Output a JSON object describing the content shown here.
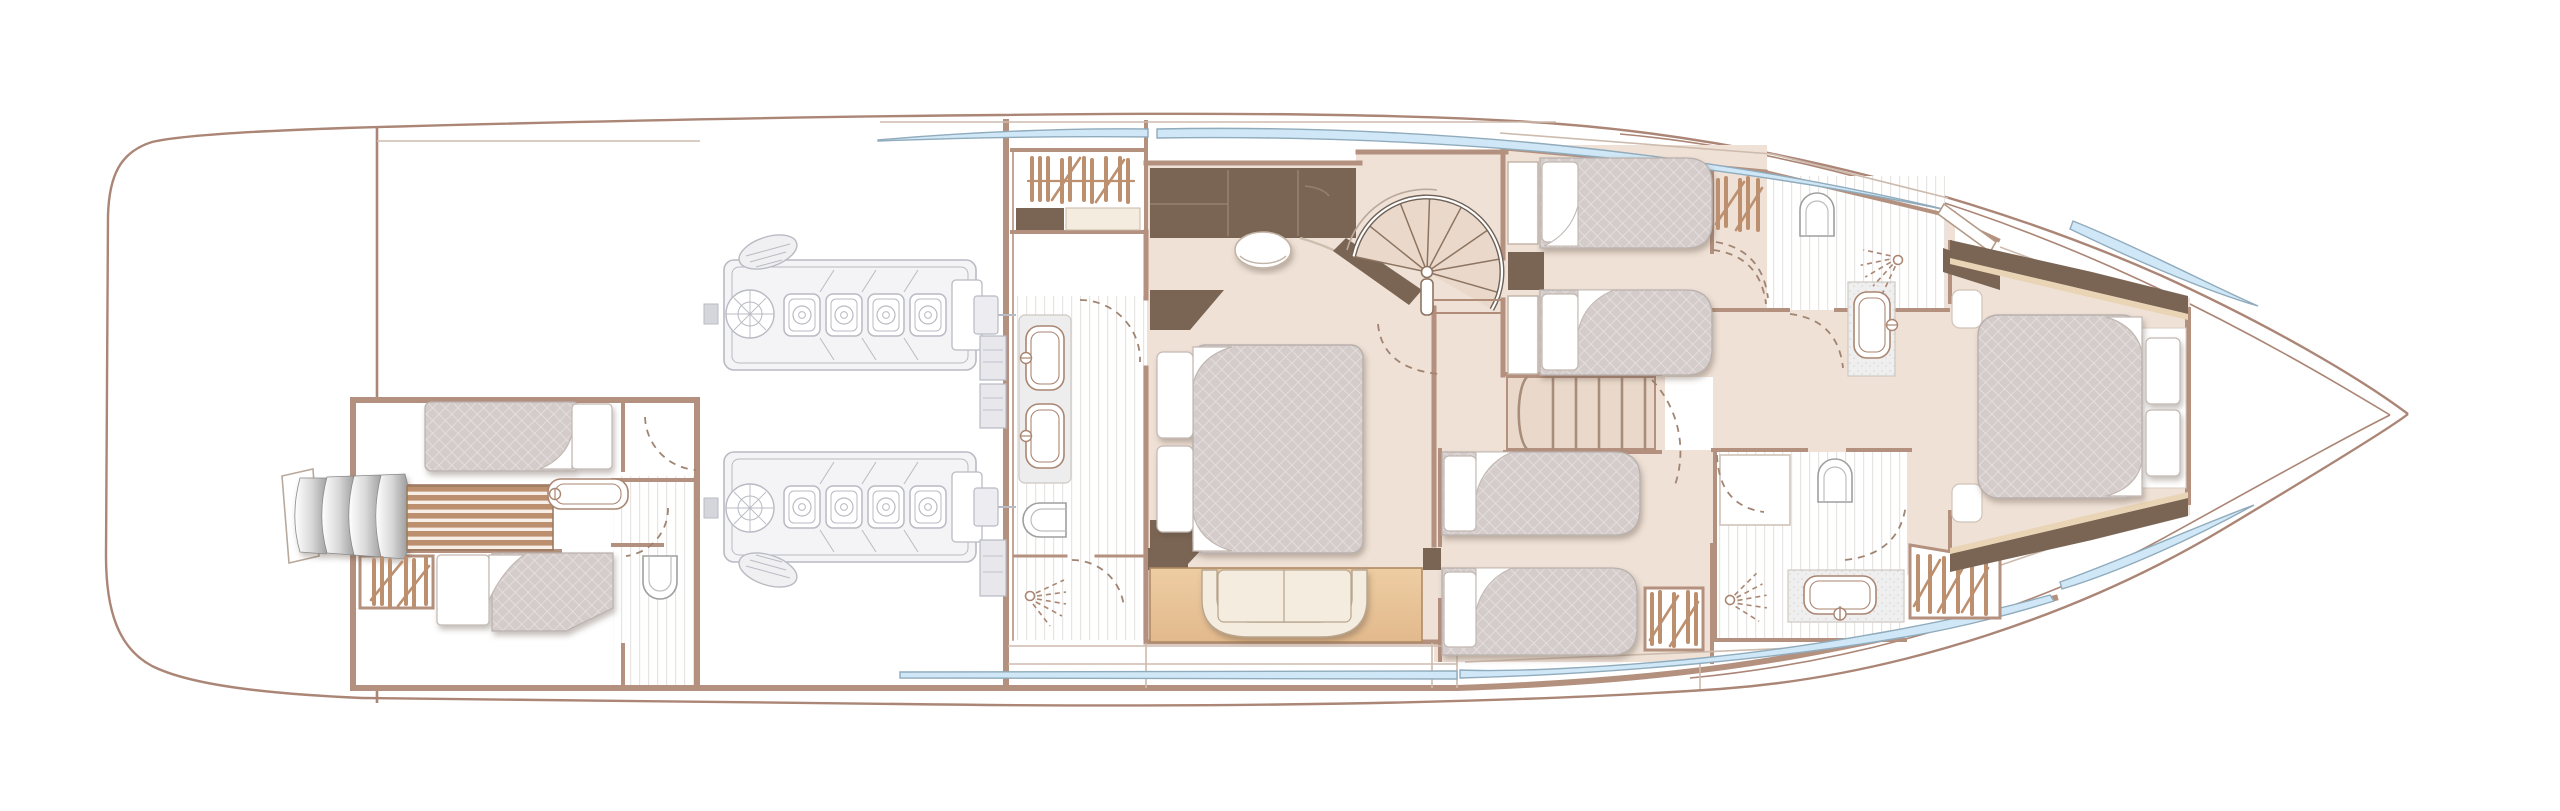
{
  "meta": {
    "title": "Yacht lower deck floor plan (no text labels in drawing)",
    "orientation": "bow-right",
    "canvas": {
      "width": 2560,
      "height": 811
    },
    "background": "#ffffff"
  },
  "palette": {
    "wall": "#b4907e",
    "hull": "#ab8575",
    "deck_line": "#cdbbae",
    "floor": "#efe1d6",
    "floor_warm": "#ead9cb",
    "fabric": "#d4ccca",
    "fabric_grid": "#e8e3e2",
    "fabric_edge": "#b9b0ac",
    "dark_furniture": "#7a6554",
    "dark_seam": "#93816f",
    "wood": "#bc8f6f",
    "wood_pale": "#f7efe7",
    "tan": "#eecda3",
    "tan_deep": "#e2b98c",
    "cream": "#f3ecdf",
    "cream_edge": "#b7a58e",
    "glass_blue": "#cfe7f6",
    "glass_edge": "#90abbc",
    "steel_dark": "#8f8f8f",
    "engine_line": "#b9bac3",
    "engine_fill": "#f4f4f7",
    "counter": "#ededee",
    "tile": "#e7e4e1",
    "fixture": "#aa8672",
    "dashc": "#a08472",
    "vip_trim": "#e9d5b6"
  },
  "inventory": {
    "rooms": [
      {
        "id": "aft-crew-cabin",
        "berths": 2
      },
      {
        "id": "aft-bathroom",
        "toilets": 1,
        "sinks": 1
      },
      {
        "id": "engine-room",
        "engines": 2
      },
      {
        "id": "master-walk-in-wardrobe"
      },
      {
        "id": "master-bathroom",
        "sinks": 2,
        "toilets": 1,
        "showers": 1
      },
      {
        "id": "master-cabin",
        "double_beds": 1,
        "sofas": 1
      },
      {
        "id": "starboard-twin-cabin",
        "berths": 2
      },
      {
        "id": "port-twin-cabin",
        "berths": 2
      },
      {
        "id": "forward-bathroom-starboard",
        "toilets": 1,
        "sinks": 1,
        "showers": 1
      },
      {
        "id": "forward-bathroom-port",
        "toilets": 1,
        "sinks": 1,
        "showers": 1
      },
      {
        "id": "vip-cabin",
        "double_beds": 1
      }
    ],
    "stairs": [
      "transom-curved-steps",
      "aft-cabin-wood-steps",
      "spiral-staircase",
      "companionway-stairs"
    ],
    "window_bands": 6
  }
}
